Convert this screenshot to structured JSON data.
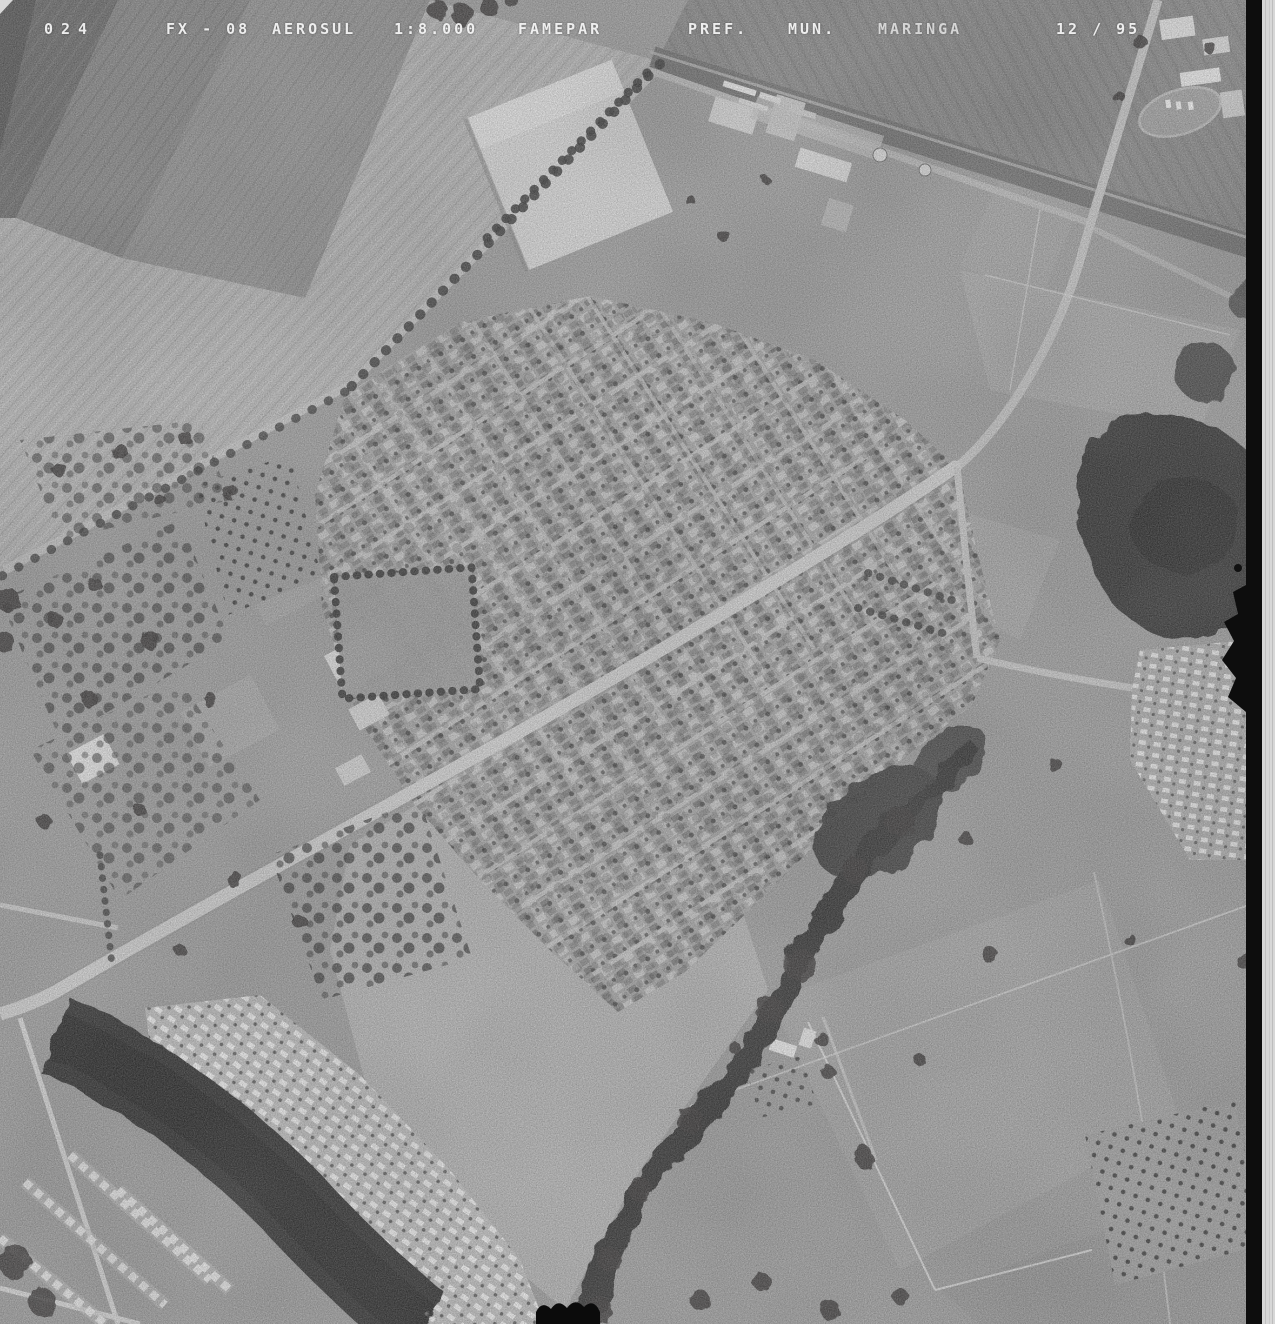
{
  "header": {
    "photo_number": "024",
    "flight_line": "FX - 08",
    "company": "AEROSUL",
    "scale": "1:8.000",
    "agency": "FAMEPAR",
    "client_prefix": "PREF.",
    "client_municipality": "MUN.",
    "city": "MARINGA",
    "date": "12 / 95"
  },
  "palette": {
    "film_edge": "#0d0d0d",
    "film_margin": "#d7d7d7",
    "ground_base": "#a4a4a4",
    "field_light": "#b9b9b9",
    "forest_dark": "#3d3d3d",
    "road_light": "#d2d2d2",
    "annotation_text": "#f4f4f4"
  }
}
